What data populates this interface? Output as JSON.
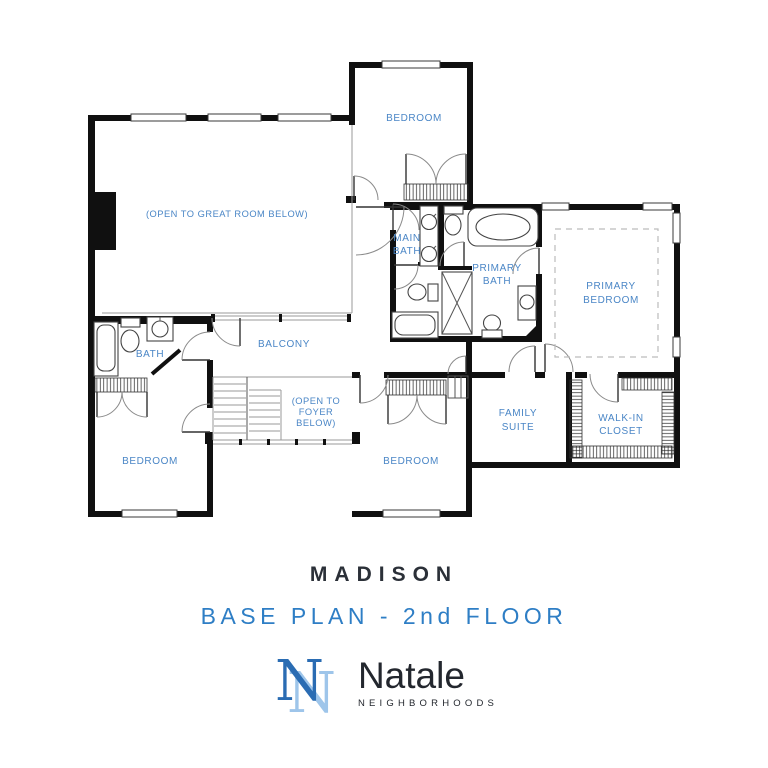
{
  "colors": {
    "wall": "#101010",
    "label_blue": "#4a86c6",
    "title_dark": "#2b3038",
    "subtitle_blue": "#2e7ec5",
    "brand_dark": "#23272e",
    "monogram_dark": "#2a6cb3",
    "monogram_light": "#9ec5ea"
  },
  "floorplan": {
    "labels": {
      "bedroom_top": "BEDROOM",
      "open_great_room": "(OPEN TO GREAT ROOM BELOW)",
      "main_bath": [
        "MAIN",
        "BATH"
      ],
      "primary_bath": [
        "PRIMARY",
        "BATH"
      ],
      "primary_bedroom": [
        "PRIMARY",
        "BEDROOM"
      ],
      "bath": "BATH",
      "balcony": "BALCONY",
      "open_foyer": [
        "(OPEN TO",
        "FOYER",
        "BELOW)"
      ],
      "family_suite": [
        "FAMILY",
        "SUITE"
      ],
      "walk_in_closet": [
        "WALK-IN",
        "CLOSET"
      ],
      "bedroom_left": "BEDROOM",
      "bedroom_middle": "BEDROOM"
    }
  },
  "title_block": {
    "plan_name": "MADISON",
    "subtitle": "BASE PLAN - 2nd FLOOR"
  },
  "brand": {
    "name": "Natale",
    "tagline": "NEIGHBORHOODS",
    "monogram_letter": "N"
  }
}
